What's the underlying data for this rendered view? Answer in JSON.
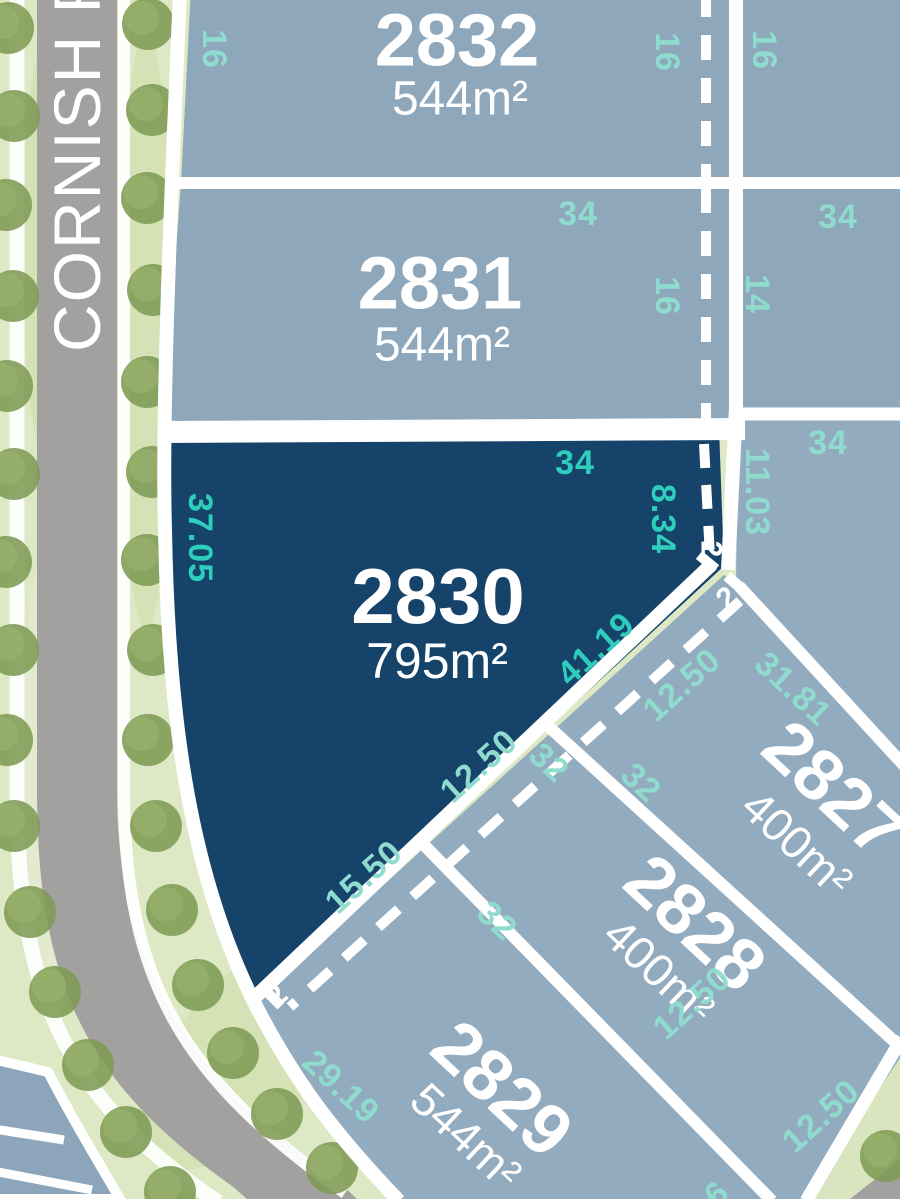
{
  "street": {
    "name": "CORNISH R"
  },
  "lots": {
    "l2832": {
      "number": "2832",
      "area": "544m²"
    },
    "l2831": {
      "number": "2831",
      "area": "544m²"
    },
    "l2830": {
      "number": "2830",
      "area": "795m²",
      "highlighted": true
    },
    "l2827": {
      "number": "2827",
      "area": "400m²"
    },
    "l2828": {
      "number": "2828",
      "area": "400m²"
    },
    "l2829": {
      "number": "2829",
      "area": "544m²"
    }
  },
  "dimensions": [
    {
      "text": "16"
    },
    {
      "text": "16"
    },
    {
      "text": "16"
    },
    {
      "text": "34"
    },
    {
      "text": "34"
    },
    {
      "text": "16"
    },
    {
      "text": "14"
    },
    {
      "text": "34"
    },
    {
      "text": "34"
    },
    {
      "text": "11.03"
    },
    {
      "text": "37.05"
    },
    {
      "text": "8.34"
    },
    {
      "text": "41.19"
    },
    {
      "text": "12.50"
    },
    {
      "text": "31.81"
    },
    {
      "text": "32"
    },
    {
      "text": "32"
    },
    {
      "text": "12.50"
    },
    {
      "text": "15.50"
    },
    {
      "text": "32"
    },
    {
      "text": "29.19"
    },
    {
      "text": "12.50"
    },
    {
      "text": "12.50"
    },
    {
      "text": "6"
    }
  ],
  "chamfers": [
    {
      "text": "2"
    },
    {
      "text": "2"
    },
    {
      "text": "2"
    }
  ],
  "colors": {
    "lot_light": "#8EA7BB",
    "lot_light_alt": "#93ABBF",
    "lot_highlight": "#15436A",
    "dim_teal_on_light": "#8FDCCF",
    "dim_teal_on_dark": "#2FCDBB",
    "boundary_white": "#FFFFFF",
    "road_grey": "#A2A19F",
    "grass_green": "#DDE8C5",
    "tree_green": "#7E9B54"
  }
}
